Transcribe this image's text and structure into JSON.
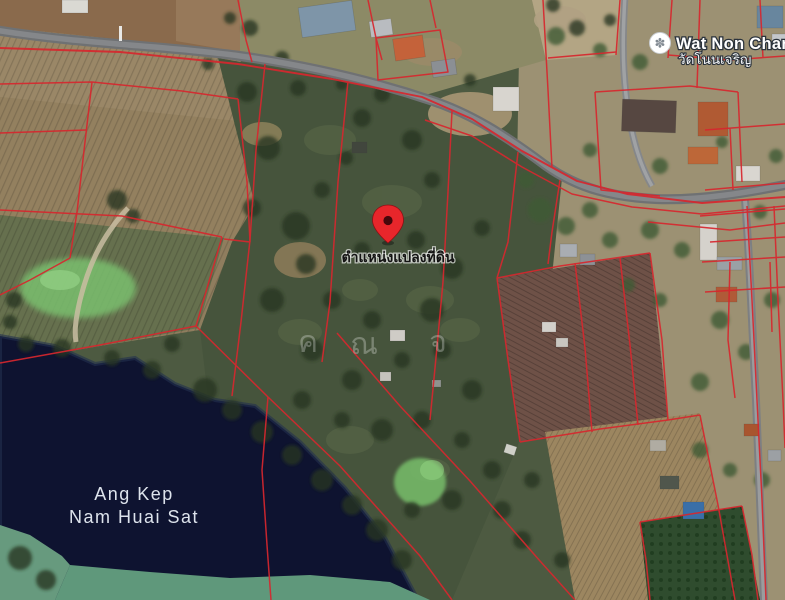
{
  "map": {
    "poi_temple": {
      "name_en": "Wat Non Charoe",
      "name_th": "วัดโนนเจริญ",
      "icon_glyph": "✽"
    },
    "plot_marker": {
      "label": "ตำแหน่งแปลงที่ดิน"
    },
    "water_label": {
      "line1": "Ang Kep",
      "line2": "Nam Huai Sat"
    },
    "watermark_glyphs": [
      "ค",
      "ณ",
      "จ"
    ],
    "colors": {
      "parcel_line": "#d7272e",
      "marker_pin": "#e8262b",
      "water": "#0e1330",
      "road": "#85878a",
      "label_text": "#ffffff"
    }
  }
}
